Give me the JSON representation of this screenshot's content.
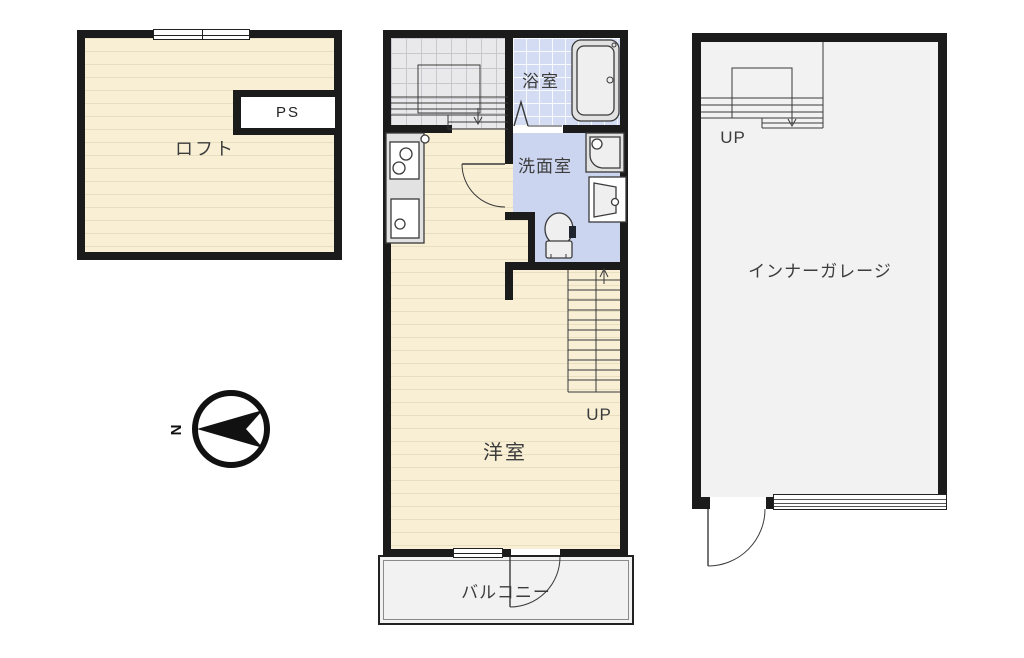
{
  "figure_type": "floor-plan",
  "plans": {
    "loft": {
      "room_label": "ロフト",
      "ps_label": "PS"
    },
    "main_floor": {
      "bath_label": "浴室",
      "washroom_label": "洗面室",
      "room_label": "洋室",
      "balcony_label": "バルコニー",
      "stairs_label": "UP"
    },
    "garage": {
      "room_label": "インナーガレージ",
      "stairs_label": "UP"
    }
  },
  "compass": {
    "north_label": "N"
  },
  "colors": {
    "wall": "#1b1b1b",
    "floor_wood": "#f8efd5",
    "floor_wood_line": "#e8dec0",
    "bath_tile": "#d3dcf2",
    "washroom_fill": "#ccd5ef",
    "gray_floor": "#f2f2f2",
    "stair_gray": "#e9e9ec",
    "fixture_fill": "#e2e2e2",
    "line": "#3a3a3a"
  }
}
